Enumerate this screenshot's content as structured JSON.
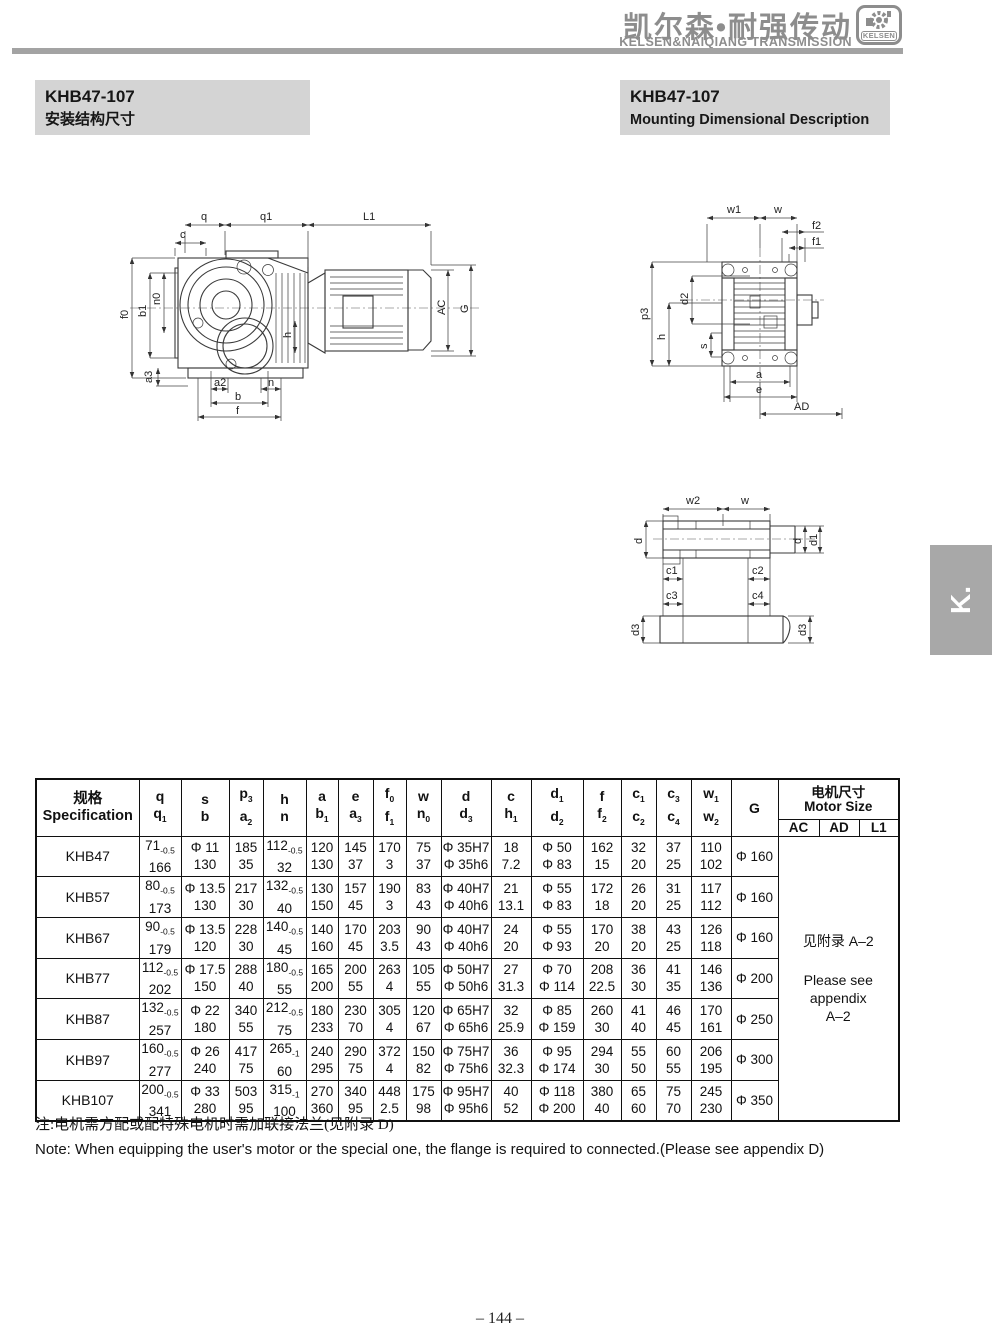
{
  "header": {
    "brand_cn": "凯尔森•耐强传动",
    "brand_en": "KELSEN&NAIQIANG TRANSMISSION",
    "logo_text": "KELSEN"
  },
  "title_left": {
    "model": "KHB47-107",
    "subtitle": "安装结构尺寸"
  },
  "title_right": {
    "model": "KHB47-107",
    "subtitle": "Mounting Dimensional Description"
  },
  "side_tab": {
    "label": "K."
  },
  "drawings": {
    "side_view": {
      "labels": {
        "q": "q",
        "q1": "q1",
        "L1": "L1",
        "c": "c",
        "f0": "f0",
        "b1": "b1",
        "n0": "n0",
        "a3": "a3",
        "a2": "a2",
        "b": "b",
        "f": "f",
        "n": "n",
        "h": "h",
        "AC": "AC",
        "G": "G"
      }
    },
    "end_view": {
      "labels": {
        "w1": "w1",
        "w": "w",
        "f2": "f2",
        "f1": "f1",
        "p3": "p3",
        "h": "h",
        "d2": "d2",
        "s": "s",
        "a": "a",
        "e": "e",
        "AD": "AD"
      }
    },
    "shaft_view": {
      "labels": {
        "w2": "w2",
        "w": "w",
        "d_left": "d",
        "d_right": "d",
        "d1": "d1",
        "c1": "c1",
        "c2": "c2",
        "c3": "c3",
        "c4": "c4",
        "d3_left": "d3",
        "d3_right": "d3"
      }
    }
  },
  "table": {
    "spec_header": [
      "规格",
      "Specification"
    ],
    "dim_headers": [
      [
        "q",
        "q|1"
      ],
      [
        "s",
        "b"
      ],
      [
        "p|3",
        "a|2"
      ],
      [
        "h",
        "n"
      ],
      [
        "a",
        "b|1"
      ],
      [
        "e",
        "a|3"
      ],
      [
        "f|0",
        "f|1"
      ],
      [
        "w",
        "n|0"
      ],
      [
        "d",
        "d|3"
      ],
      [
        "c",
        "h|1"
      ],
      [
        "d|1",
        "d|2"
      ],
      [
        "f",
        "f|2"
      ],
      [
        "c|1",
        "c|2"
      ],
      [
        "c|3",
        "c|4"
      ],
      [
        "w|1",
        "w|2"
      ]
    ],
    "g_header": "G",
    "motor_group": {
      "title_cn": "电机尺寸",
      "title_en": "Motor Size",
      "subcols": [
        "AC",
        "AD",
        "L1"
      ],
      "note_cn": "见附录 A–2",
      "note_en_lines": [
        "Please see",
        "appendix",
        "A–2"
      ]
    },
    "rows": [
      {
        "model": "KHB47",
        "cells": [
          [
            "71|-0.5",
            "166"
          ],
          [
            "Φ 11",
            "130"
          ],
          [
            "185",
            "35"
          ],
          [
            "112|-0.5",
            "32"
          ],
          [
            "120",
            "130"
          ],
          [
            "145",
            "37"
          ],
          [
            "170",
            "3"
          ],
          [
            "75",
            "37"
          ],
          [
            "Φ 35H7",
            "Φ 35h6"
          ],
          [
            "18",
            "7.2"
          ],
          [
            "Φ 50",
            "Φ 83"
          ],
          [
            "162",
            "15"
          ],
          [
            "32",
            "20"
          ],
          [
            "37",
            "25"
          ],
          [
            "110",
            "102"
          ]
        ],
        "g": "Φ 160"
      },
      {
        "model": "KHB57",
        "cells": [
          [
            "80|-0.5",
            "173"
          ],
          [
            "Φ 13.5",
            "130"
          ],
          [
            "217",
            "30"
          ],
          [
            "132|-0.5",
            "40"
          ],
          [
            "130",
            "150"
          ],
          [
            "157",
            "45"
          ],
          [
            "190",
            "3"
          ],
          [
            "83",
            "43"
          ],
          [
            "Φ 40H7",
            "Φ 40h6"
          ],
          [
            "21",
            "13.1"
          ],
          [
            "Φ 55",
            "Φ 83"
          ],
          [
            "172",
            "18"
          ],
          [
            "26",
            "20"
          ],
          [
            "31",
            "25"
          ],
          [
            "117",
            "112"
          ]
        ],
        "g": "Φ 160"
      },
      {
        "model": "KHB67",
        "cells": [
          [
            "90|-0.5",
            "179"
          ],
          [
            "Φ 13.5",
            "120"
          ],
          [
            "228",
            "30"
          ],
          [
            "140|-0.5",
            "45"
          ],
          [
            "140",
            "160"
          ],
          [
            "170",
            "45"
          ],
          [
            "203",
            "3.5"
          ],
          [
            "90",
            "43"
          ],
          [
            "Φ 40H7",
            "Φ 40h6"
          ],
          [
            "24",
            "20"
          ],
          [
            "Φ 55",
            "Φ 93"
          ],
          [
            "170",
            "20"
          ],
          [
            "38",
            "20"
          ],
          [
            "43",
            "25"
          ],
          [
            "126",
            "118"
          ]
        ],
        "g": "Φ 160"
      },
      {
        "model": "KHB77",
        "cells": [
          [
            "112|-0.5",
            "202"
          ],
          [
            "Φ 17.5",
            "150"
          ],
          [
            "288",
            "40"
          ],
          [
            "180|-0.5",
            "55"
          ],
          [
            "165",
            "200"
          ],
          [
            "200",
            "55"
          ],
          [
            "263",
            "4"
          ],
          [
            "105",
            "55"
          ],
          [
            "Φ 50H7",
            "Φ 50h6"
          ],
          [
            "27",
            "31.3"
          ],
          [
            "Φ 70",
            "Φ 114"
          ],
          [
            "208",
            "22.5"
          ],
          [
            "36",
            "30"
          ],
          [
            "41",
            "35"
          ],
          [
            "146",
            "136"
          ]
        ],
        "g": "Φ 200"
      },
      {
        "model": "KHB87",
        "cells": [
          [
            "132|-0.5",
            "257"
          ],
          [
            "Φ 22",
            "180"
          ],
          [
            "340",
            "55"
          ],
          [
            "212|-0.5",
            "75"
          ],
          [
            "180",
            "233"
          ],
          [
            "230",
            "70"
          ],
          [
            "305",
            "4"
          ],
          [
            "120",
            "67"
          ],
          [
            "Φ 65H7",
            "Φ 65h6"
          ],
          [
            "32",
            "25.9"
          ],
          [
            "Φ 85",
            "Φ 159"
          ],
          [
            "260",
            "30"
          ],
          [
            "41",
            "40"
          ],
          [
            "46",
            "45"
          ],
          [
            "170",
            "161"
          ]
        ],
        "g": "Φ 250"
      },
      {
        "model": "KHB97",
        "cells": [
          [
            "160|-0.5",
            "277"
          ],
          [
            "Φ 26",
            "240"
          ],
          [
            "417",
            "75"
          ],
          [
            "265|-1",
            "60"
          ],
          [
            "240",
            "295"
          ],
          [
            "290",
            "75"
          ],
          [
            "372",
            "4"
          ],
          [
            "150",
            "82"
          ],
          [
            "Φ 75H7",
            "Φ 75h6"
          ],
          [
            "36",
            "32.3"
          ],
          [
            "Φ 95",
            "Φ 174"
          ],
          [
            "294",
            "30"
          ],
          [
            "55",
            "50"
          ],
          [
            "60",
            "55"
          ],
          [
            "206",
            "195"
          ]
        ],
        "g": "Φ 300"
      },
      {
        "model": "KHB107",
        "cells": [
          [
            "200|-0.5",
            "341"
          ],
          [
            "Φ 33",
            "280"
          ],
          [
            "503",
            "95"
          ],
          [
            "315|-1",
            "100"
          ],
          [
            "270",
            "360"
          ],
          [
            "340",
            "95"
          ],
          [
            "448",
            "2.5"
          ],
          [
            "175",
            "98"
          ],
          [
            "Φ 95H7",
            "Φ 95h6"
          ],
          [
            "40",
            "52"
          ],
          [
            "Φ 118",
            "Φ 200"
          ],
          [
            "380",
            "40"
          ],
          [
            "65",
            "60"
          ],
          [
            "75",
            "70"
          ],
          [
            "245",
            "230"
          ]
        ],
        "g": "Φ 350"
      }
    ]
  },
  "notes": {
    "cn": "注:电机需方配或配特殊电机时需加联接法兰(见附录 D)",
    "en": "Note: When equipping the user's motor or the special one, the flange is required to connected.(Please see appendix D)"
  },
  "page_number": "– 144 –"
}
